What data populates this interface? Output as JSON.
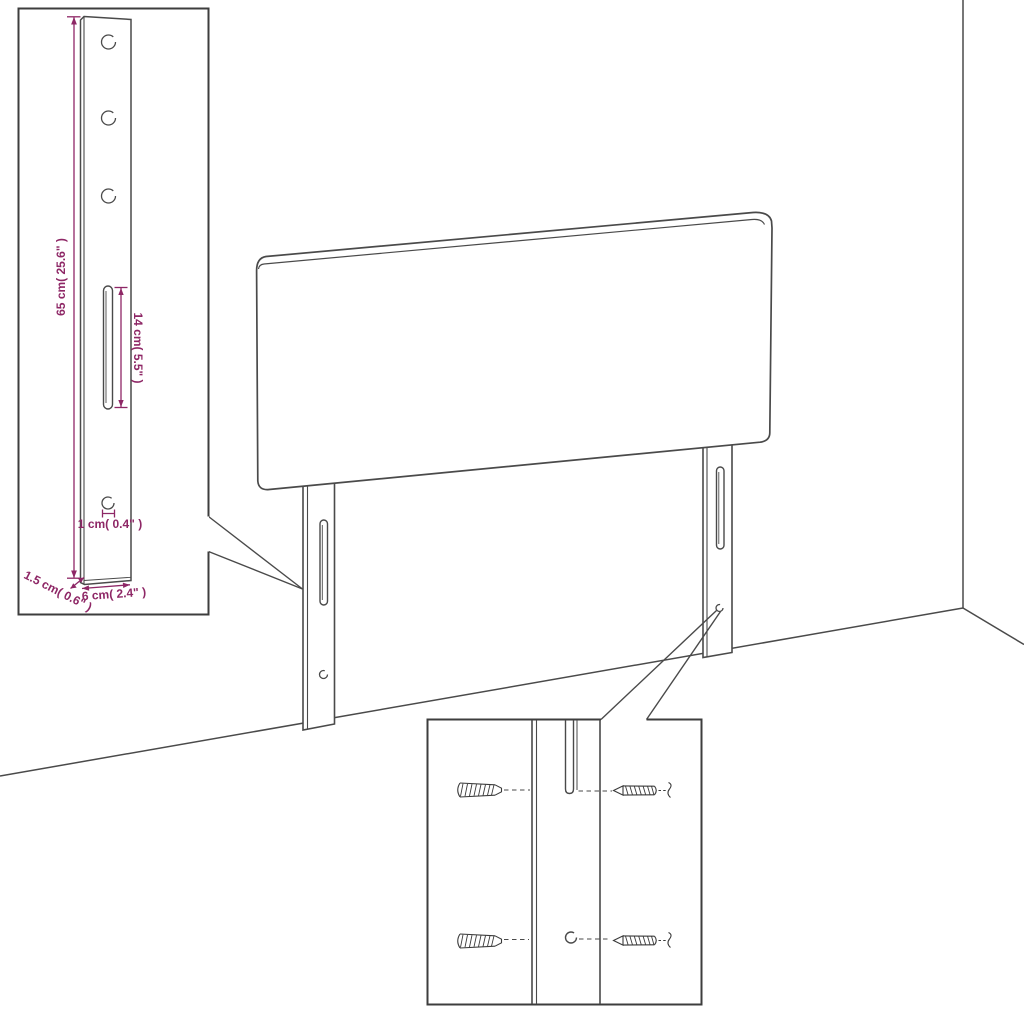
{
  "colors": {
    "background": "#ffffff",
    "line": "#4a4a4a",
    "inset_border": "#3d3d3d",
    "dimension": "#8e2766"
  },
  "dimension_labels": {
    "leg_height": "65 cm( 25.6\" )",
    "slot_length": "14 cm( 5.5\" )",
    "hole_diameter": "1 cm( 0.4\" )",
    "leg_depth": "1.5 cm( 0.6\" )",
    "leg_width": "6 cm( 2.4\" )"
  },
  "leg_detail_inset": {
    "top_holes": 3,
    "slots": 1,
    "bottom_holes": 1
  },
  "hardware_detail_inset": {
    "wall_plugs": 2,
    "screws": 2
  }
}
